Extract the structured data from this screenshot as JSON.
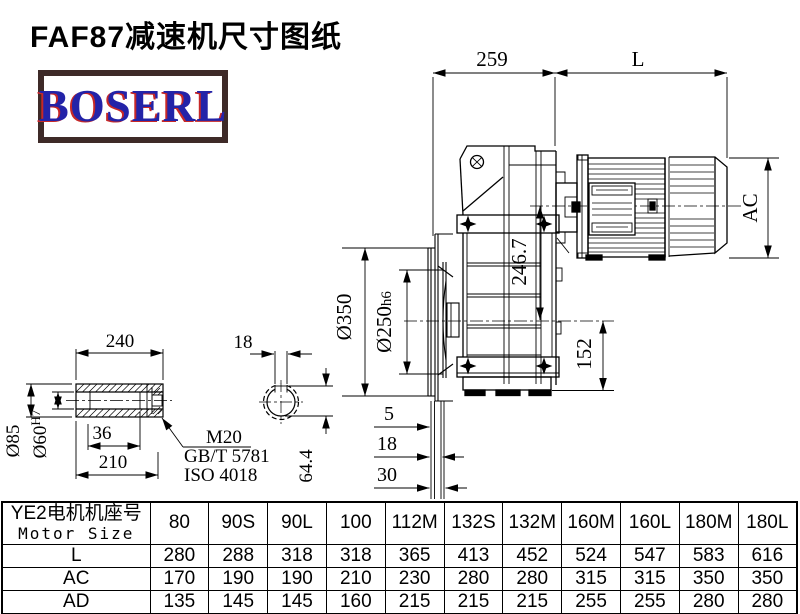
{
  "title": "FAF87减速机尺寸图纸",
  "logo": {
    "text": "BOSERL"
  },
  "drawing": {
    "dim_259": "259",
    "dim_L": "L",
    "dim_AC": "AC",
    "dim_246_7": "246.7",
    "dim_152": "152",
    "dim_d350": "Ø350",
    "dim_d250": "Ø250",
    "dim_d250_tol": "h6",
    "dim_5": "5",
    "dim_18": "18",
    "dim_30": "30",
    "shaft": {
      "dim_240": "240",
      "dim_d85": "Ø85",
      "dim_d60": "Ø60",
      "dim_d60_tol": "H7",
      "dim_36": "36",
      "dim_210": "210",
      "thread": "M20",
      "std1": "GB/T 5781",
      "std2": "ISO 4018",
      "key_width": "18",
      "key_depth": "64.4"
    }
  },
  "table": {
    "header_cn": "YE2电机机座号",
    "header_en": "Motor Size",
    "columns": [
      "80",
      "90S",
      "90L",
      "100",
      "112M",
      "132S",
      "132M",
      "160M",
      "160L",
      "180M",
      "180L"
    ],
    "rows": [
      {
        "label": "L",
        "values": [
          "280",
          "288",
          "318",
          "318",
          "365",
          "413",
          "452",
          "524",
          "547",
          "583",
          "616"
        ]
      },
      {
        "label": "AC",
        "values": [
          "170",
          "190",
          "190",
          "210",
          "230",
          "280",
          "280",
          "315",
          "315",
          "350",
          "350"
        ]
      },
      {
        "label": "AD",
        "values": [
          "135",
          "145",
          "145",
          "160",
          "215",
          "215",
          "215",
          "255",
          "255",
          "280",
          "280"
        ]
      }
    ]
  }
}
